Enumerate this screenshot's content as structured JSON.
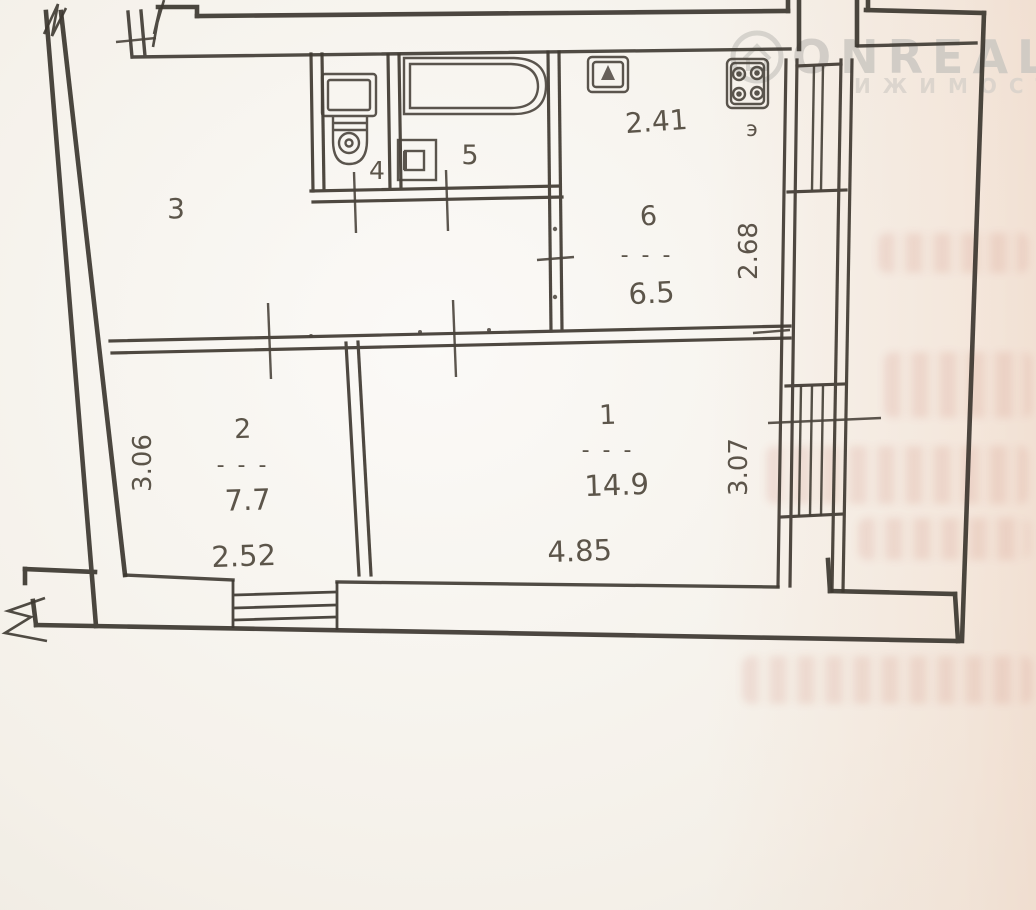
{
  "page": {
    "background_color": "#f6f3ed",
    "wall_color": "#38332c",
    "label_color": "#4f473c",
    "bleed_tint_color": "#f2d6c4"
  },
  "watermark": {
    "brand": "ONREALT",
    "subtitle_visible": "ИЖИМОСТ",
    "icon": "house-in-circle-icon",
    "color": "#ccc8c2"
  },
  "plan": {
    "separator": "- - -",
    "rooms": {
      "r1": {
        "number": "1",
        "area": "14.9",
        "width": "4.85",
        "depth": "3.07"
      },
      "r2": {
        "number": "2",
        "area": "7.7",
        "width": "2.52",
        "depth": "3.06"
      },
      "r3": {
        "number": "3"
      },
      "r4": {
        "number": "4"
      },
      "r5": {
        "number": "5"
      },
      "r6": {
        "number": "6",
        "area": "6.5",
        "width": "2.41",
        "depth": "2.68",
        "stove_marker": "э"
      }
    },
    "fixtures": [
      "toilet-icon",
      "bathtub-icon",
      "sink-icon",
      "kitchen-sink-icon",
      "stove-icon"
    ]
  }
}
